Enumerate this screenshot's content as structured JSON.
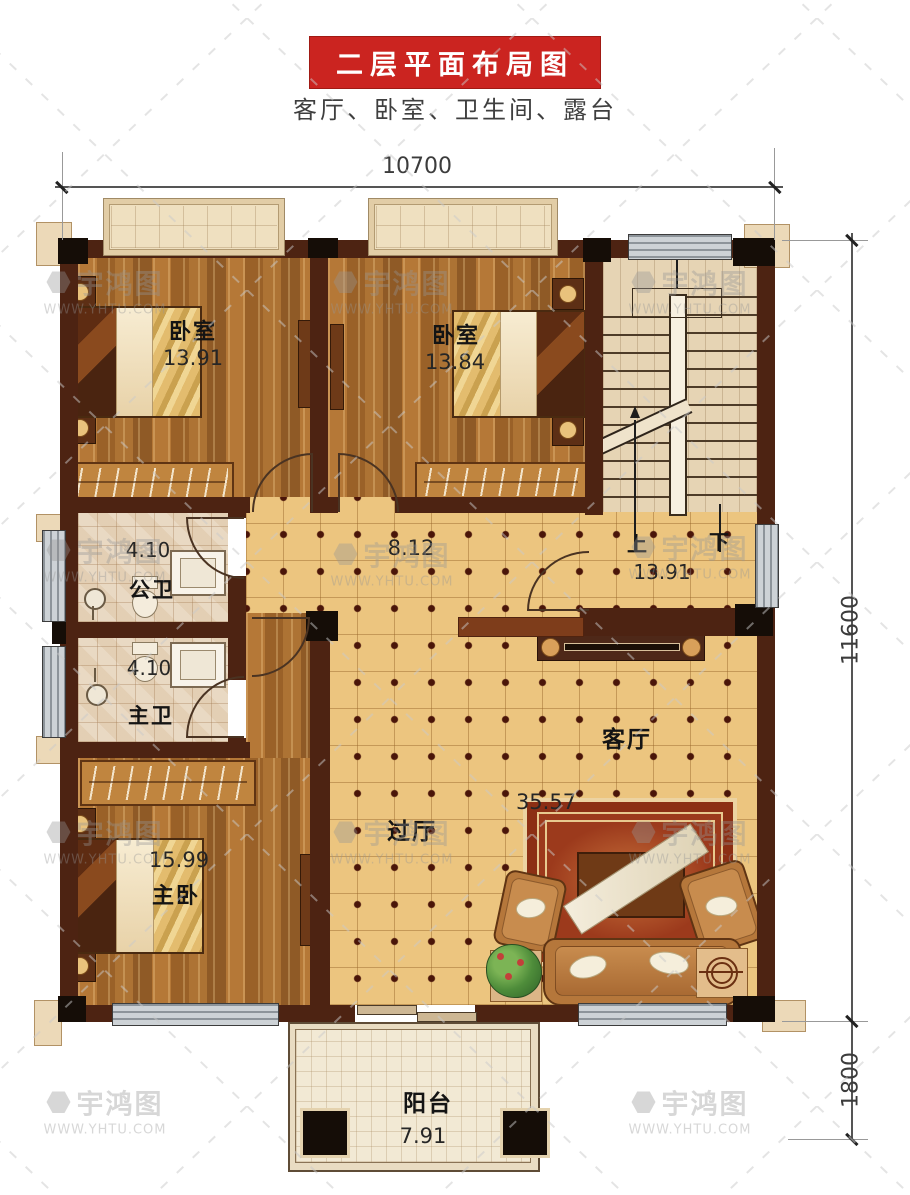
{
  "header": {
    "title": "二层平面布局图",
    "subtitle": "客厅、卧室、卫生间、露台"
  },
  "dimensions": {
    "top": "10700",
    "right": "11600",
    "balcony": "1800"
  },
  "rooms": {
    "bedroom1": {
      "name": "卧室",
      "area": "13.91"
    },
    "bedroom2": {
      "name": "卧室",
      "area": "13.84"
    },
    "stairwell": {
      "up": "上",
      "down": "下",
      "area": "13.91"
    },
    "bath_public": {
      "name": "公卫",
      "area": "4.10"
    },
    "bath_master": {
      "name": "主卫",
      "area": "4.10"
    },
    "hallway": {
      "name": "过厅",
      "area": "8.12"
    },
    "living_room": {
      "name": "客厅",
      "area": "35.57"
    },
    "master_bedroom": {
      "name": "主卧",
      "area": "15.99"
    },
    "balcony": {
      "name": "阳台",
      "area": "7.91"
    }
  },
  "watermark": {
    "brand": "宇鸿图",
    "url": "WWW.YHTU.COM"
  },
  "colors": {
    "title_bg": "#cb2420",
    "wall": "#4d2312",
    "wood_floor": "#a86c30",
    "hall_tile": "#ecc57f",
    "stair_wood": "#e6d4b4",
    "rug_red": "#9c3a1c"
  }
}
